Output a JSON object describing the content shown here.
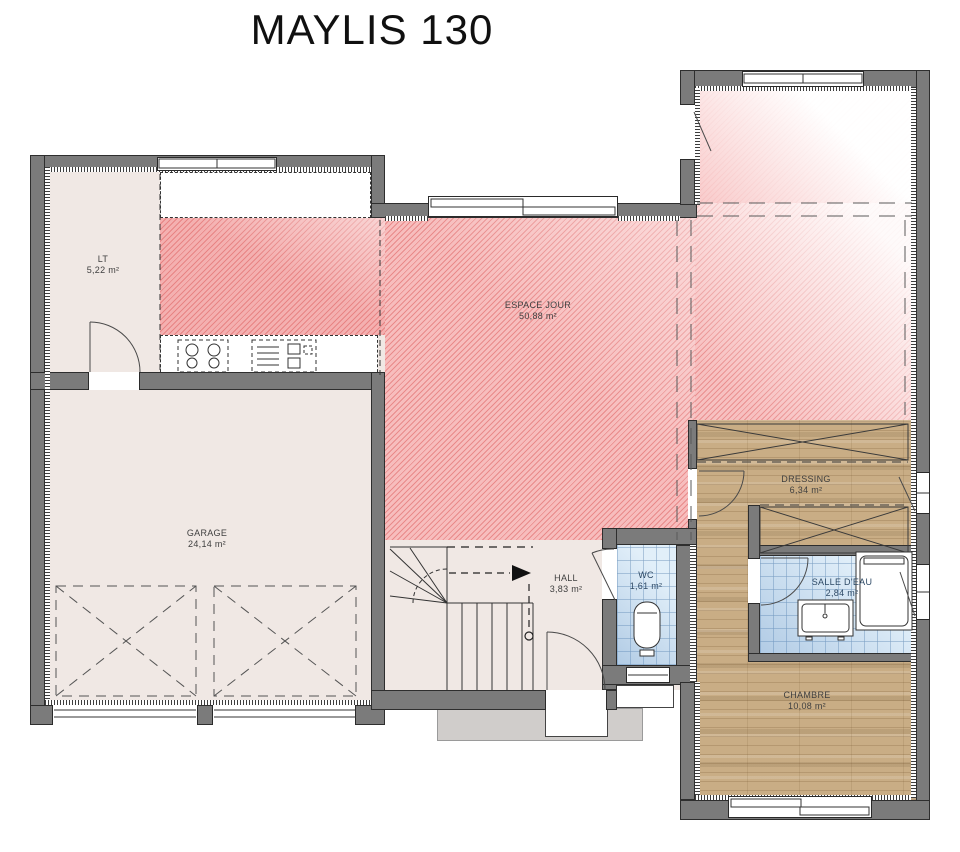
{
  "title": "MAYLIS 130",
  "rooms": [
    {
      "id": "lt",
      "name": "LT",
      "area": "5,22 m²"
    },
    {
      "id": "espace-jour",
      "name": "ESPACE JOUR",
      "area": "50,88 m²"
    },
    {
      "id": "garage",
      "name": "GARAGE",
      "area": "24,14 m²"
    },
    {
      "id": "hall",
      "name": "HALL",
      "area": "3,83 m²"
    },
    {
      "id": "wc",
      "name": "WC",
      "area": "1,61 m²"
    },
    {
      "id": "dressing",
      "name": "DRESSING",
      "area": "6,34 m²"
    },
    {
      "id": "salle-deau",
      "name": "SALLE D'EAU",
      "area": "2,84 m²"
    },
    {
      "id": "chambre",
      "name": "CHAMBRE",
      "area": "10,08 m²"
    }
  ],
  "colors": {
    "wall": "#7b7b7b",
    "floor_pink": "#f7bdbd",
    "floor_wood": "#c9ad85",
    "floor_tile": "#dcecf8",
    "floor_beige": "#f0e8e4"
  }
}
